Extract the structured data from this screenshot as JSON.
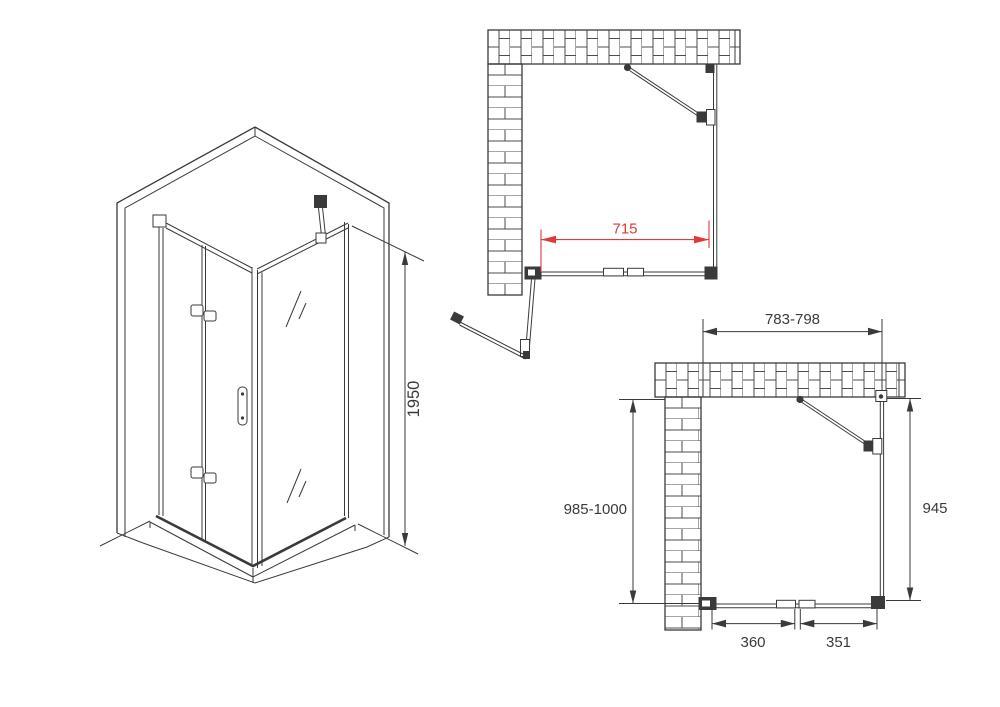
{
  "title": "Corner shower enclosure with bi-fold door - technical drawing",
  "colors": {
    "background": "#ffffff",
    "ink": "#3a3a3a",
    "accent_red": "#e03a36",
    "brick_line": "#4d4d4d"
  },
  "isometric_view": {
    "height_dimension_label": "1950"
  },
  "top_plan_view": {
    "opening_width_dimension_label": "715"
  },
  "front_plan_view": {
    "overall_width_dimension_label": "783-798",
    "left_height_dimension_label": "985-1000",
    "right_height_dimension_label": "945",
    "left_door_panel_dimension_label": "360",
    "right_door_panel_dimension_label": "351"
  }
}
